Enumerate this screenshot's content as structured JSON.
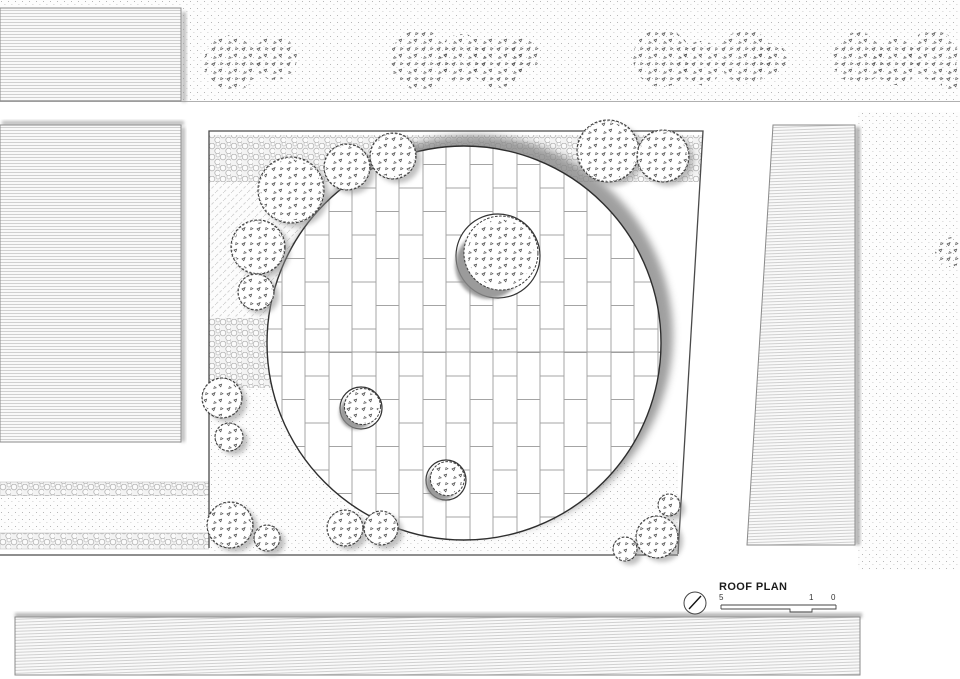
{
  "drawing": {
    "title": "ROOF PLAN",
    "scale": {
      "labels": [
        "5",
        "1",
        "0"
      ]
    }
  },
  "colors": {
    "linework": "#3c3c3c",
    "shadow": "#8a8a8a",
    "hatch": "#c6c6c6",
    "stipple_dot": "#a8a8a8",
    "pebble": "#b4b4b4",
    "tile_joint": "#a4a4a4",
    "paper": "#ffffff"
  },
  "plaza": {
    "outline": "209,131 703,131 678,554 209,554",
    "circle": {
      "cx": 464,
      "cy": 343,
      "r": 197
    },
    "tile": {
      "width": 23.5,
      "height": 47
    },
    "joint_line_y": 352
  },
  "trees": {
    "leafy": [
      [
        291,
        190,
        33
      ],
      [
        347,
        167,
        23
      ],
      [
        393,
        156,
        23
      ],
      [
        258,
        247,
        27
      ],
      [
        256,
        292,
        18
      ],
      [
        222,
        398,
        20
      ],
      [
        229,
        437,
        14
      ],
      [
        230,
        525,
        23
      ],
      [
        267,
        538,
        13
      ],
      [
        345,
        528,
        18
      ],
      [
        381,
        528,
        17
      ],
      [
        625,
        549,
        12
      ],
      [
        657,
        537,
        21
      ],
      [
        669,
        505,
        11
      ],
      [
        608,
        151,
        31
      ],
      [
        663,
        156,
        26
      ]
    ],
    "clusters": [
      [
        232,
        63,
        28
      ],
      [
        275,
        58,
        22
      ],
      [
        420,
        60,
        30
      ],
      [
        462,
        58,
        24
      ],
      [
        497,
        62,
        26
      ],
      [
        523,
        55,
        17
      ],
      [
        662,
        58,
        29
      ],
      [
        701,
        63,
        22
      ],
      [
        746,
        57,
        27
      ],
      [
        771,
        60,
        17
      ],
      [
        858,
        58,
        26
      ],
      [
        896,
        62,
        23
      ],
      [
        933,
        55,
        25
      ],
      [
        953,
        78,
        14
      ],
      [
        950,
        252,
        15
      ]
    ],
    "planters": [
      [
        498,
        256,
        42,
        37
      ],
      [
        361,
        408,
        21,
        18
      ],
      [
        446,
        480,
        20,
        17
      ]
    ]
  }
}
